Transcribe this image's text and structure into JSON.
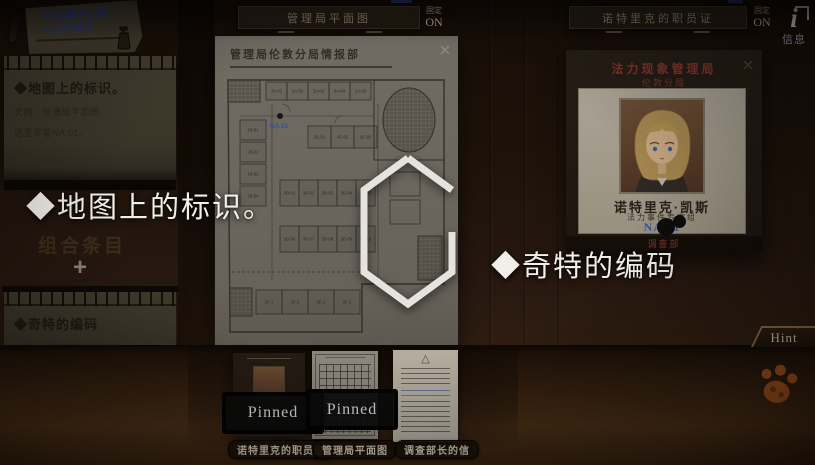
{
  "sticky_note": {
    "line1": "转至案件记录",
    "line2": "&打印菜单"
  },
  "top_bar": {
    "map_tab": {
      "label": "管理局平面图",
      "pin_label": "固定",
      "pin_state": "ON"
    },
    "id_tab": {
      "label": "诺特里克的职员证",
      "pin_label": "固定",
      "pin_state": "ON"
    },
    "info": {
      "glyph": "i",
      "label": "信息"
    }
  },
  "notes": {
    "first": {
      "title": "◆地图上的标识。",
      "doc_line": "文档：管理局平面图",
      "body": "这里写着NA 01。"
    },
    "add_label": "+",
    "second": {
      "title": "◆奇特的编码",
      "doc_line": "文档：诺特里克的职员证",
      "body": "这里写的NA 01是什么意思？"
    },
    "combine_label": "组合条目"
  },
  "map_panel": {
    "title": "管理局伦敦分局情报部",
    "close_glyph": "×",
    "marker_code": "NA 01",
    "rooms": [
      "3A-01",
      "3A-02",
      "3A-03",
      "3A-04",
      "1A-03",
      "1B-01",
      "1B-02",
      "1B-03",
      "1B-04",
      "3C-01",
      "3C-02",
      "3C-03",
      "3D-01",
      "3D-02",
      "3D-03",
      "3D-04",
      "3D-05",
      "3D-06",
      "3D-07",
      "3D-08",
      "3D-09",
      "3D-10",
      "1F-1",
      "1F-2",
      "2F-1",
      "2F-2"
    ]
  },
  "id_panel": {
    "org": "法力现象管理局",
    "branch": "伦敦分局",
    "close_glyph": "×",
    "name": "诺特里克·凯斯",
    "team": "法力事件专案组",
    "code": "NA 01",
    "dept": "调查部"
  },
  "captions": {
    "left": "◆地图上的标识。",
    "right": "◆奇特的编码"
  },
  "shelf": {
    "items": [
      {
        "label": "诺特里克的职员证",
        "stamp": "Pinned"
      },
      {
        "label": "管理局平面图",
        "stamp": "Pinned"
      },
      {
        "label": "调查部长的信",
        "stamp": ""
      }
    ]
  },
  "hint_button": {
    "label": "Hint"
  },
  "colors": {
    "code_blue": "#33539f",
    "caption_white": "#f2efe9",
    "header_red": "#7e352c",
    "paw_orange": "#a8551e",
    "stamp_black": "#0b0b0b"
  }
}
